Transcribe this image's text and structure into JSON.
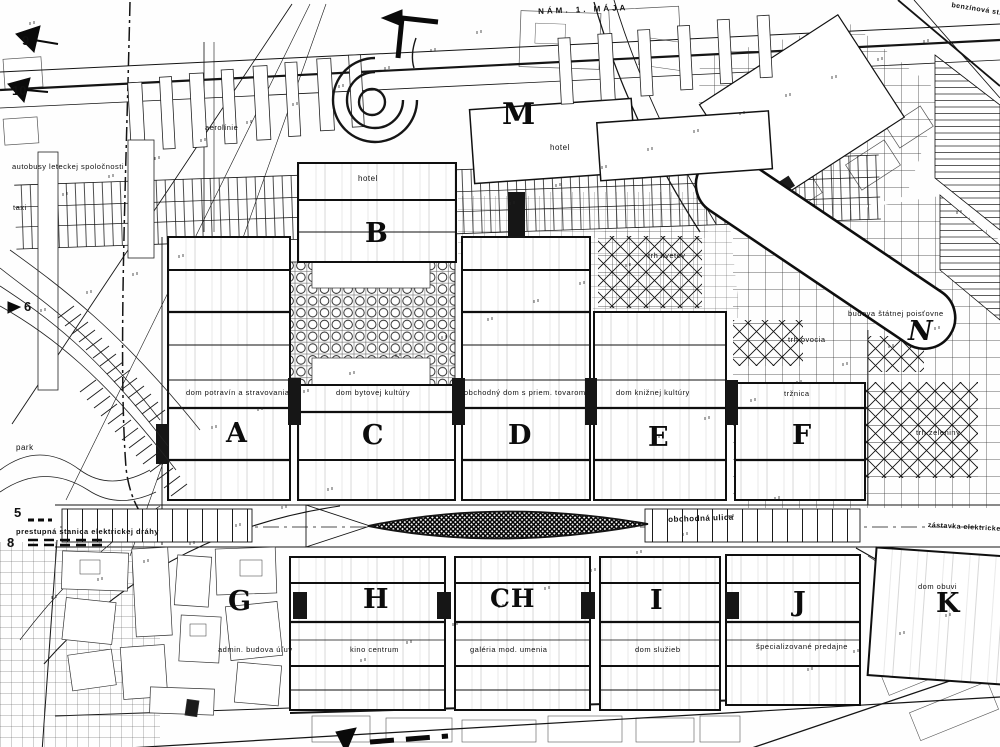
{
  "palette": {
    "paper": "#fefefe",
    "ink": "#111111"
  },
  "map": {
    "street_labels": [
      {
        "id": "street-nam-1-maja",
        "text": "NÁM. 1. MÁJA",
        "x": 538,
        "y": 8,
        "size": 8,
        "rotate": -2.5,
        "spacing": 3
      },
      {
        "id": "street-obchodna-ulica",
        "text": "obchodná ulica",
        "x": 668,
        "y": 516,
        "size": 8,
        "rotate": -2
      },
      {
        "id": "street-benzinova-stanica",
        "text": "benzínová st.",
        "x": 952,
        "y": 2,
        "size": 7,
        "rotate": 9
      },
      {
        "id": "street-zastavka-elektrickej-drahy",
        "text": "zástavka elektrickej dráhy",
        "x": 928,
        "y": 522,
        "size": 7,
        "rotate": 3
      },
      {
        "id": "street-prestupna-stanica",
        "text": "prestupná stanica elektrickej dráhy",
        "x": 16,
        "y": 528,
        "size": 7.5
      }
    ],
    "area_labels": [
      {
        "id": "area-park",
        "text": "park",
        "x": 16,
        "y": 444,
        "size": 8
      },
      {
        "id": "area-taxi",
        "text": "taxi",
        "x": 13,
        "y": 204,
        "size": 7.5
      },
      {
        "id": "area-aerolinie",
        "text": "aerolínie",
        "x": 205,
        "y": 124,
        "size": 7.5
      },
      {
        "id": "area-autobusy-leteckej-spolocnosti",
        "text": "autobusy leteckej spoločnosti",
        "x": 12,
        "y": 163,
        "size": 7.5
      },
      {
        "id": "area-trh-kvetov",
        "text": "trh kvetov",
        "x": 648,
        "y": 252,
        "size": 7.5
      },
      {
        "id": "area-trh-ovocia",
        "text": "trh ovocia",
        "x": 788,
        "y": 336,
        "size": 7.5
      },
      {
        "id": "area-trh-zeleniny",
        "text": "trh zeleniny",
        "x": 916,
        "y": 429,
        "size": 7.5
      }
    ],
    "building_labels": [
      {
        "id": "bldg-hotel-b",
        "text": "hotel",
        "x": 358,
        "y": 175,
        "size": 8
      },
      {
        "id": "bldg-hotel-m",
        "text": "hotel",
        "x": 550,
        "y": 144,
        "size": 8
      },
      {
        "id": "bldg-dom-potravin",
        "text": "dom potravín a stravovania",
        "x": 186,
        "y": 389,
        "size": 7.5
      },
      {
        "id": "bldg-dom-bytovej-kultury",
        "text": "dom bytovej kultúry",
        "x": 336,
        "y": 389,
        "size": 7.5
      },
      {
        "id": "bldg-obchodny-dom",
        "text": "obchodný dom s priem. tovarom",
        "x": 464,
        "y": 389,
        "size": 7.5
      },
      {
        "id": "bldg-dom-kniznej-kultury",
        "text": "dom knižnej kultúry",
        "x": 616,
        "y": 389,
        "size": 7.5
      },
      {
        "id": "bldg-trznica",
        "text": "tržnica",
        "x": 784,
        "y": 390,
        "size": 7.5
      },
      {
        "id": "bldg-budova-statnej-poistovne",
        "text": "budova štátnej poisťovne",
        "x": 848,
        "y": 310,
        "size": 7.5
      },
      {
        "id": "bldg-admin-budova",
        "text": "admin. budova úľuv",
        "x": 218,
        "y": 646,
        "size": 7.5
      },
      {
        "id": "bldg-kino-centrum",
        "text": "kino centrum",
        "x": 350,
        "y": 646,
        "size": 7.5
      },
      {
        "id": "bldg-galeria-mod-umenia",
        "text": "galéria mod. umenia",
        "x": 470,
        "y": 646,
        "size": 7.5
      },
      {
        "id": "bldg-dom-sluzieb",
        "text": "dom služieb",
        "x": 635,
        "y": 646,
        "size": 7.5
      },
      {
        "id": "bldg-specializovane-predajne",
        "text": "špecializované predajne",
        "x": 756,
        "y": 643,
        "size": 7.5
      },
      {
        "id": "bldg-dom-obuvi",
        "text": "dom obuvi",
        "x": 918,
        "y": 583,
        "size": 7.5
      }
    ],
    "block_letters": [
      {
        "id": "block-a",
        "text": "A",
        "x": 226,
        "y": 420
      },
      {
        "id": "block-b",
        "text": "B",
        "x": 365,
        "y": 220
      },
      {
        "id": "block-c",
        "text": "C",
        "x": 362,
        "y": 422
      },
      {
        "id": "block-d",
        "text": "D",
        "x": 508,
        "y": 422
      },
      {
        "id": "block-e",
        "text": "E",
        "x": 648,
        "y": 424
      },
      {
        "id": "block-f",
        "text": "F",
        "x": 792,
        "y": 422
      },
      {
        "id": "block-g",
        "text": "G",
        "x": 228,
        "y": 588
      },
      {
        "id": "block-h",
        "text": "H",
        "x": 363,
        "y": 586
      },
      {
        "id": "block-ch",
        "text": "CH",
        "x": 490,
        "y": 586,
        "size": 25
      },
      {
        "id": "block-i",
        "text": "I",
        "x": 650,
        "y": 587
      },
      {
        "id": "block-j",
        "text": "J",
        "x": 793,
        "y": 589
      },
      {
        "id": "block-k",
        "text": "K",
        "x": 936,
        "y": 590
      },
      {
        "id": "block-m",
        "text": "M",
        "x": 502,
        "y": 100,
        "size": 30
      },
      {
        "id": "block-n",
        "text": "N",
        "x": 908,
        "y": 318,
        "italic": true
      }
    ],
    "markers": [
      {
        "id": "marker-9",
        "text": "9",
        "x": 22,
        "y": 34
      },
      {
        "id": "marker-10",
        "text": "10",
        "x": 12,
        "y": 84
      },
      {
        "id": "marker-6",
        "text": "6",
        "x": 24,
        "y": 300
      },
      {
        "id": "marker-5",
        "text": "5",
        "x": 14,
        "y": 506
      },
      {
        "id": "marker-8",
        "text": "8",
        "x": 7,
        "y": 536
      }
    ]
  }
}
